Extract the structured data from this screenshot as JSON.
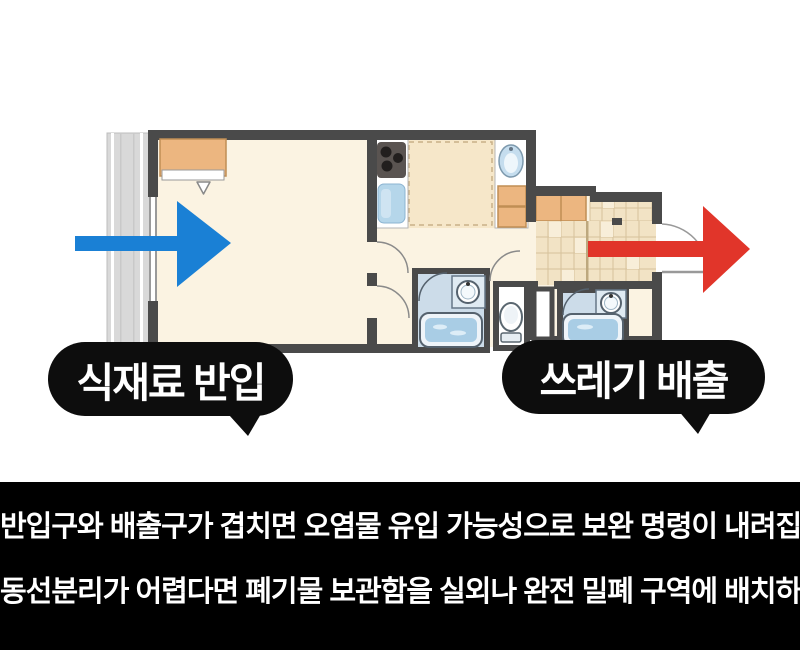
{
  "scene": {
    "background": "#ffffff",
    "caption_panel_bg": "#000000"
  },
  "floorplan": {
    "wall_color": "#4a4a4a",
    "room_floor_color": "#fbf3e2",
    "kitchen_floor_color": "#f6e7c9",
    "entry_tile_color": "#f2e3c5",
    "cabinet_color": "#ecb680",
    "balcony_color": "#d9d9d9",
    "fixture_blue": "#b5d6ea",
    "unit_panel_blue": "#ccdce9",
    "bath_water_blue": "#a9cde5"
  },
  "arrows": {
    "inflow_color": "#1a80d5",
    "outflow_color": "#e1352a"
  },
  "bubbles": {
    "inflow": {
      "text": "식재료 반입",
      "bg": "#0d0d0d",
      "fg": "#ffffff"
    },
    "outflow": {
      "text": "쓰레기 배출",
      "bg": "#0d0d0d",
      "fg": "#ffffff"
    }
  },
  "caption": {
    "lines": [
      "반입구와 배출구가 겹치면 오염물 유입 가능성으로 보완 명령이 내려집니다.",
      "동선분리가 어렵다면 폐기물 보관함을 실외나 완전 밀폐 구역에 배치하세요."
    ]
  }
}
